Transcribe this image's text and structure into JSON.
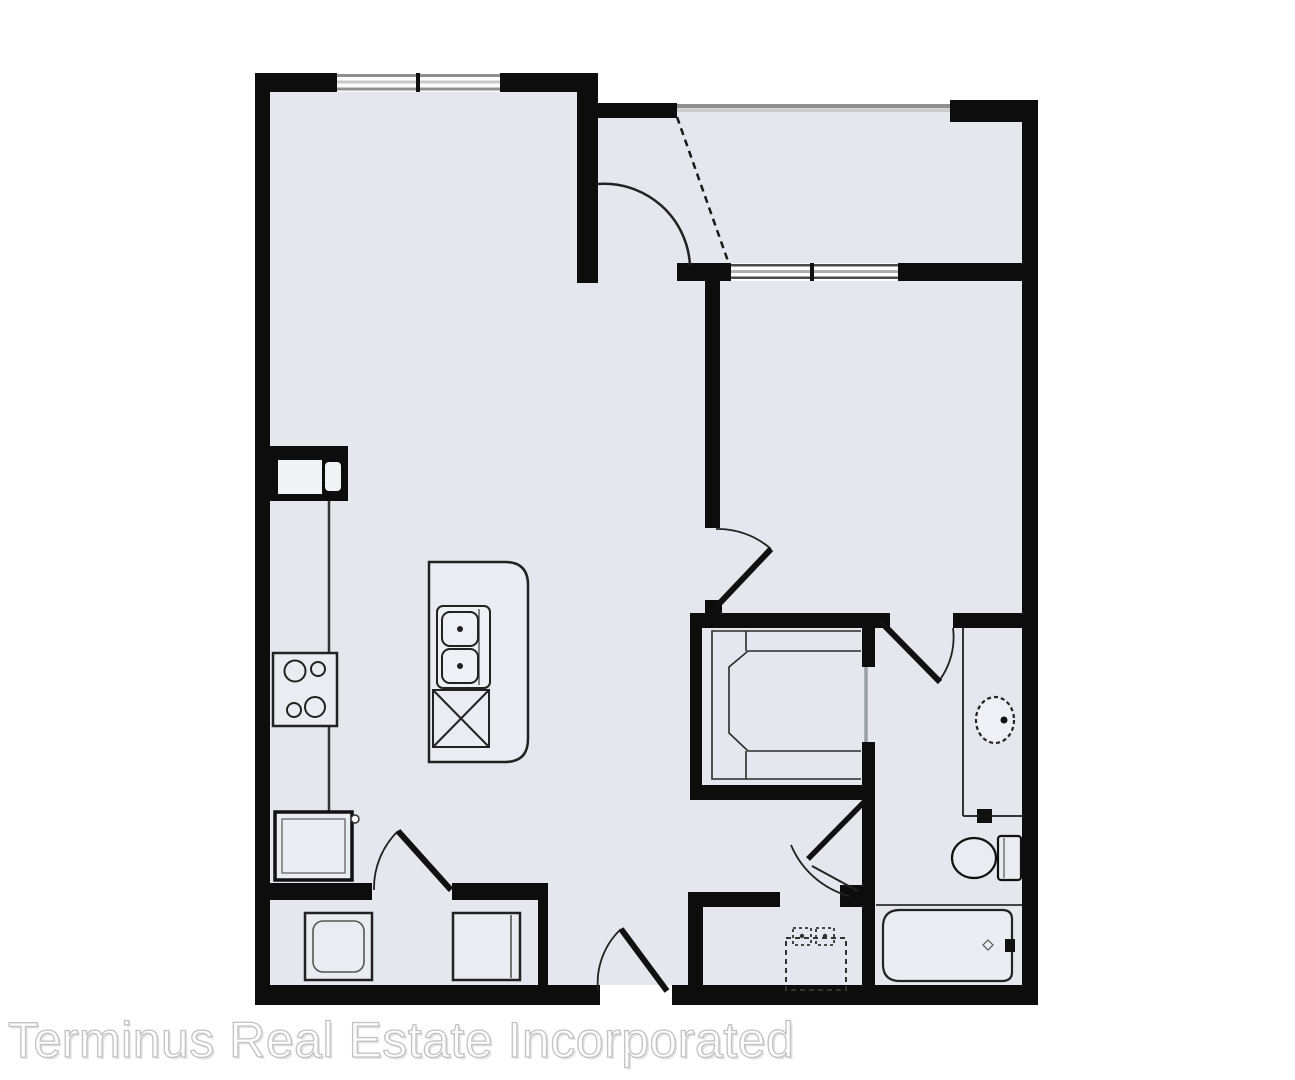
{
  "watermark": {
    "text": "Terminus Real Estate Incorporated"
  },
  "colors": {
    "outside": "#ffffff",
    "floor": "#e4e7ee",
    "floor_light": "#eaedf2",
    "wall": "#0d0d0d",
    "fixture_line": "#222222",
    "window_frame": "#8f8f8f",
    "window_glass": "#c8c8c8",
    "watermark_fill": "#fdfdfd",
    "watermark_outline": "#c2c2c2",
    "watermark_shadow": "#e3e3e3"
  },
  "floorplan": {
    "kind": "one-bedroom apartment floor plan",
    "rooms": [
      "living-dining-area",
      "kitchen",
      "foyer-patio",
      "bedroom",
      "walk-in-closet",
      "bathroom",
      "laundry-closet",
      "utility-nook",
      "entry-vestibule"
    ],
    "fixtures": [
      "refrigerator",
      "range-cooktop",
      "pantry-cabinet",
      "kitchen-island",
      "double-basin-sink",
      "dishwasher",
      "washer",
      "dryer",
      "wardrobe-shelving",
      "sliding-closet-door",
      "vanity-counter",
      "vanity-sink",
      "toilet",
      "bathtub",
      "utility-hookup"
    ],
    "doors": [
      "patio-door",
      "bedroom-door",
      "bathroom-door",
      "utility-door",
      "laundry-door",
      "entry-door"
    ],
    "windows": [
      "living-room-window",
      "patio-screen",
      "bedroom-window"
    ]
  }
}
